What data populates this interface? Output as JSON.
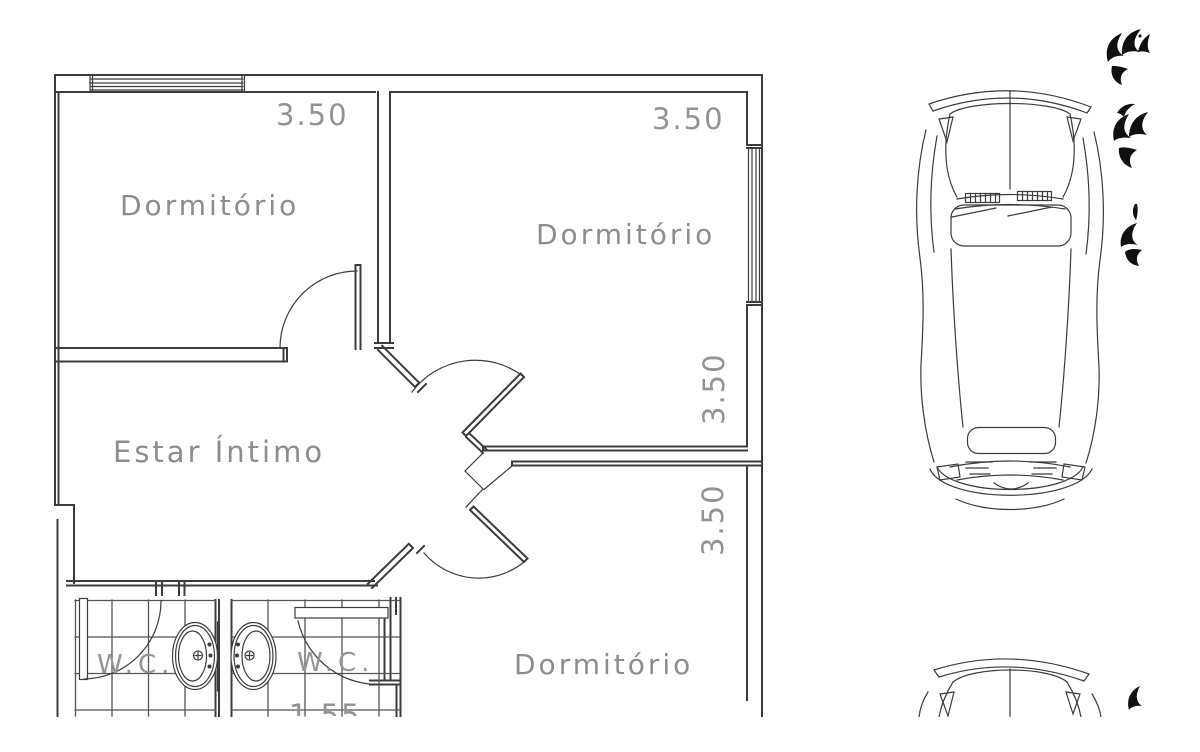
{
  "drawing": {
    "rooms": {
      "dorm1": "Dormitório",
      "dorm2": "Dormitório",
      "dorm3": "Dormitório",
      "estar": "Estar Íntimo",
      "wc1": "W.C.",
      "wc2": "W.C."
    },
    "dimensions": {
      "dim_top_left": "3.50",
      "dim_top_right": "3.50",
      "dim_right_upper": "3.50",
      "dim_right_lower": "3.50",
      "dim_bottom_partial": "1.55"
    },
    "colors": {
      "line": "#3c3c3c",
      "leaf": "#101010",
      "text": "#8d8d8d",
      "background": "#ffffff"
    }
  }
}
